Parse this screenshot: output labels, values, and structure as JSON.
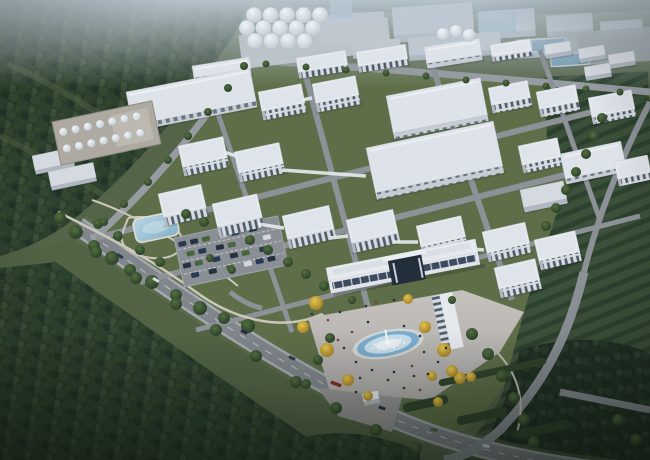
{
  "meta": {
    "description": "Aerial dusk rendering of an industrial park: grid of white factory buildings and warehouses, silo cluster, tank farm, park with pond and parking lot, central admin building with fountain plaza, surrounded by forest and field rows",
    "canvas": {
      "width": 650,
      "height": 460
    }
  },
  "palette": {
    "haze": "#c4cfd9",
    "distant_block": "#aeb9c6",
    "distant_roof": "#cdd6df",
    "glass": "#8fb0c6",
    "forest_base": "#2a3c29",
    "forest_dark": "#223425",
    "clearing": "#5c6b4a",
    "lawn": "#5f7047",
    "meadow": "#546444",
    "meadow_light": "#64744d",
    "road": "#85898e",
    "road_light": "#a9aeb2",
    "road_dash": "#d8dcdf",
    "path": "#d2ccbe",
    "plaza_a": "#cbc7c2",
    "plaza_b": "#b2aeab",
    "apron": "#9b9896",
    "roof_white": "#eef1f5",
    "roof_shade": "#e0e5eb",
    "roof_edge": "#c7ccd4",
    "warehouse_roof": "#e5e9ef",
    "shed_roof": "#dce0e6",
    "end_wall": "#b6bcc6",
    "win_base": "#dde1e7",
    "win_glass": "#4e5c6a",
    "wh_face": "#ccd2d9",
    "wh_glass": "#5a6876",
    "band_glass": "#3d4c5e",
    "portal": "#222e3a",
    "canopy": "#f2f4f7",
    "silo_pad": "#c6cdd4",
    "tank_yard": "#b3aea4",
    "tank_edge": "#938e84",
    "pool_rim": "#dadcd9",
    "pool_deep": "#7fb2d4",
    "pool_light": "#cfe6f2",
    "pond_edge": "#e9e5da",
    "hedge": "#2f4429",
    "people": "#2b2f36",
    "people_alt": "#7d3b30",
    "basin": "#6f98b2",
    "pad_grey": "#98a1a3",
    "car_colors": [
      "#49683c",
      "#2b3a54",
      "#24303e",
      "#d8dde2",
      "#8a2b22"
    ]
  },
  "scene": {
    "silos": {
      "x": 254,
      "y": 15,
      "dx": 16.5,
      "dy": 13,
      "r": 8,
      "rows": [
        5,
        5,
        4
      ],
      "row_offset": [
        0,
        -7,
        1
      ]
    },
    "domes": [
      [
        443,
        34,
        6.5
      ],
      [
        456,
        31,
        6.5
      ],
      [
        469,
        35,
        6.5
      ]
    ],
    "tanks": {
      "x": 9,
      "y": 12,
      "dx": 12.5,
      "dy": 17,
      "r": 4.3,
      "rows": 2,
      "cols": 7
    },
    "skybridges": [
      [
        224,
        152,
        236,
        156
      ],
      [
        302,
        100,
        312,
        98
      ],
      [
        282,
        170,
        366,
        176
      ],
      [
        258,
        224,
        284,
        228
      ],
      [
        330,
        238,
        348,
        236
      ],
      [
        394,
        242,
        418,
        242
      ],
      [
        460,
        248,
        484,
        250
      ]
    ],
    "hedges": [
      [
        402,
        404,
        46,
        9
      ],
      [
        456,
        417,
        52,
        9
      ],
      [
        514,
        431,
        56,
        9
      ],
      [
        438,
        380,
        110,
        7
      ]
    ],
    "trees_green": [
      [
        60,
        218,
        6
      ],
      [
        76,
        232,
        7
      ],
      [
        94,
        246,
        6
      ],
      [
        112,
        258,
        7
      ],
      [
        130,
        270,
        6
      ],
      [
        152,
        282,
        7
      ],
      [
        176,
        295,
        6
      ],
      [
        200,
        308,
        7
      ],
      [
        224,
        318,
        6
      ],
      [
        248,
        326,
        7
      ],
      [
        118,
        236,
        5
      ],
      [
        98,
        224,
        5
      ],
      [
        140,
        250,
        5
      ],
      [
        160,
        262,
        5
      ],
      [
        186,
        214,
        5
      ],
      [
        204,
        222,
        5
      ],
      [
        250,
        240,
        5
      ],
      [
        268,
        250,
        5
      ],
      [
        288,
        262,
        5
      ],
      [
        306,
        274,
        5
      ],
      [
        324,
        286,
        5
      ],
      [
        210,
        258,
        4
      ],
      [
        232,
        270,
        4
      ],
      [
        96,
        252,
        6
      ],
      [
        136,
        278,
        6
      ],
      [
        176,
        304,
        6
      ],
      [
        216,
        330,
        6
      ],
      [
        256,
        356,
        6
      ],
      [
        296,
        382,
        6
      ],
      [
        336,
        408,
        6
      ],
      [
        376,
        430,
        6
      ],
      [
        416,
        448,
        6
      ],
      [
        472,
        334,
        6
      ],
      [
        488,
        354,
        6
      ],
      [
        502,
        376,
        6
      ],
      [
        514,
        398,
        6
      ],
      [
        524,
        420,
        6
      ],
      [
        534,
        442,
        6
      ],
      [
        546,
        226,
        5
      ],
      [
        556,
        208,
        5
      ],
      [
        566,
        190,
        5
      ],
      [
        576,
        172,
        5
      ],
      [
        586,
        154,
        5
      ],
      [
        594,
        136,
        5
      ],
      [
        602,
        118,
        5
      ],
      [
        244,
        66,
        4
      ],
      [
        228,
        88,
        4
      ],
      [
        208,
        112,
        4
      ],
      [
        188,
        136,
        4
      ],
      [
        168,
        160,
        4
      ],
      [
        148,
        182,
        4
      ],
      [
        124,
        204,
        4
      ],
      [
        104,
        222,
        4
      ],
      [
        266,
        64,
        3.5
      ],
      [
        306,
        67,
        3.5
      ],
      [
        346,
        70,
        3.5
      ],
      [
        386,
        73,
        3.5
      ],
      [
        426,
        76,
        3.5
      ],
      [
        466,
        80,
        3.5
      ],
      [
        506,
        83,
        3.5
      ],
      [
        546,
        86,
        3.5
      ],
      [
        586,
        89,
        3.5
      ],
      [
        620,
        92,
        3.5
      ],
      [
        330,
        338,
        5
      ],
      [
        318,
        360,
        5
      ],
      [
        306,
        384,
        5
      ],
      [
        352,
        300,
        4
      ],
      [
        452,
        300,
        4
      ],
      [
        618,
        420,
        6
      ],
      [
        636,
        440,
        6
      ]
    ],
    "trees_yellow": [
      [
        316,
        303,
        7
      ],
      [
        303,
        327,
        6
      ],
      [
        327,
        350,
        7
      ],
      [
        348,
        380,
        6
      ],
      [
        368,
        396,
        5
      ],
      [
        425,
        327,
        6
      ],
      [
        444,
        350,
        7
      ],
      [
        460,
        378,
        6
      ],
      [
        438,
        402,
        5
      ],
      [
        408,
        299,
        5
      ],
      [
        432,
        376,
        5
      ],
      [
        452,
        371,
        6
      ],
      [
        471,
        377,
        5
      ]
    ],
    "parking_cars": [
      [
        3,
        5,
        1
      ],
      [
        15,
        5,
        2
      ],
      [
        27,
        5,
        0
      ],
      [
        45,
        5,
        3
      ],
      [
        57,
        5,
        1
      ],
      [
        75,
        5,
        2
      ],
      [
        9,
        16,
        0
      ],
      [
        21,
        16,
        1
      ],
      [
        39,
        16,
        2
      ],
      [
        51,
        16,
        0
      ],
      [
        69,
        16,
        1
      ],
      [
        87,
        16,
        3
      ],
      [
        3,
        27,
        2
      ],
      [
        15,
        27,
        0
      ],
      [
        33,
        27,
        1
      ],
      [
        51,
        27,
        2
      ],
      [
        63,
        27,
        0
      ],
      [
        81,
        27,
        1
      ],
      [
        9,
        38,
        1
      ],
      [
        27,
        38,
        2
      ],
      [
        45,
        38,
        0
      ],
      [
        63,
        38,
        3
      ],
      [
        75,
        38,
        1
      ],
      [
        87,
        38,
        2
      ]
    ],
    "road_cars": [
      [
        120,
        256,
        1,
        33
      ],
      [
        156,
        280,
        3,
        31
      ],
      [
        198,
        306,
        0,
        29
      ],
      [
        244,
        332,
        2,
        27
      ],
      [
        292,
        358,
        1,
        24
      ],
      [
        336,
        384,
        4,
        20
      ],
      [
        382,
        408,
        2,
        17
      ],
      [
        434,
        430,
        0,
        13
      ],
      [
        486,
        446,
        3,
        10
      ],
      [
        560,
        462,
        1,
        6
      ]
    ],
    "people": [
      [
        352,
        332
      ],
      [
        344,
        348
      ],
      [
        356,
        362
      ],
      [
        372,
        370
      ],
      [
        394,
        372
      ],
      [
        412,
        366
      ],
      [
        424,
        352
      ],
      [
        420,
        336
      ],
      [
        404,
        326
      ],
      [
        368,
        322
      ],
      [
        338,
        340
      ],
      [
        360,
        378
      ],
      [
        388,
        380
      ],
      [
        414,
        376
      ],
      [
        340,
        312
      ],
      [
        328,
        320
      ],
      [
        312,
        314
      ],
      [
        446,
        348
      ],
      [
        438,
        362
      ],
      [
        428,
        374
      ],
      [
        376,
        302
      ],
      [
        394,
        300
      ],
      [
        366,
        306
      ],
      [
        404,
        388
      ],
      [
        356,
        392
      ],
      [
        420,
        390
      ]
    ]
  },
  "buildings": [
    {
      "k": "d",
      "x": 318,
      "y": 16,
      "w": 66,
      "h": 24,
      "f": 6,
      "a": -4
    },
    {
      "k": "d",
      "x": 392,
      "y": 8,
      "w": 80,
      "h": 28,
      "f": 7,
      "a": -4
    },
    {
      "k": "d",
      "x": 478,
      "y": 12,
      "w": 56,
      "h": 22,
      "f": 6,
      "a": -4
    },
    {
      "k": "d",
      "x": 408,
      "y": 38,
      "w": 92,
      "h": 18,
      "f": 5,
      "a": -4
    },
    {
      "k": "d",
      "x": 546,
      "y": 16,
      "w": 46,
      "h": 16,
      "f": 5,
      "a": -4
    },
    {
      "k": "d",
      "x": 600,
      "y": 22,
      "w": 42,
      "h": 14,
      "f": 4,
      "a": -4
    },
    {
      "k": "d",
      "x": 516,
      "y": 40,
      "w": 62,
      "h": 14,
      "f": 5,
      "a": -4
    },
    {
      "k": "d",
      "x": 352,
      "y": 42,
      "w": 48,
      "h": 13,
      "f": 4,
      "a": -4
    },
    {
      "k": "w",
      "x": 192,
      "y": 66,
      "w": 58,
      "h": 12,
      "f": 5,
      "a": -9
    },
    {
      "k": "t",
      "x": 296,
      "y": 58,
      "w": 50,
      "h": 15,
      "f": 6,
      "a": -9
    },
    {
      "k": "t",
      "x": 356,
      "y": 52,
      "w": 50,
      "h": 15,
      "f": 6,
      "a": -9
    },
    {
      "k": "w",
      "x": 424,
      "y": 47,
      "w": 56,
      "h": 17,
      "f": 5,
      "a": -9
    },
    {
      "k": "t",
      "x": 490,
      "y": 45,
      "w": 40,
      "h": 12,
      "f": 5,
      "a": -9
    },
    {
      "k": "s",
      "x": 544,
      "y": 45,
      "w": 26,
      "h": 10,
      "f": 4,
      "a": -9
    },
    {
      "k": "s",
      "x": 578,
      "y": 49,
      "w": 26,
      "h": 10,
      "f": 4,
      "a": -9
    },
    {
      "k": "s",
      "x": 608,
      "y": 55,
      "w": 26,
      "h": 10,
      "f": 4,
      "a": -9
    },
    {
      "k": "s",
      "x": 584,
      "y": 67,
      "w": 26,
      "h": 10,
      "f": 4,
      "a": -9
    },
    {
      "k": "w",
      "x": 126,
      "y": 92,
      "w": 126,
      "h": 34,
      "f": 6,
      "a": -11
    },
    {
      "k": "t",
      "x": 258,
      "y": 92,
      "w": 44,
      "h": 20,
      "f": 9,
      "a": -11
    },
    {
      "k": "t",
      "x": 312,
      "y": 84,
      "w": 44,
      "h": 20,
      "f": 9,
      "a": -11
    },
    {
      "k": "w",
      "x": 386,
      "y": 96,
      "w": 96,
      "h": 38,
      "f": 6,
      "a": -11
    },
    {
      "k": "t",
      "x": 488,
      "y": 88,
      "w": 40,
      "h": 18,
      "f": 8,
      "a": -11
    },
    {
      "k": "t",
      "x": 536,
      "y": 92,
      "w": 40,
      "h": 18,
      "f": 8,
      "a": -11
    },
    {
      "k": "t",
      "x": 588,
      "y": 98,
      "w": 44,
      "h": 20,
      "f": 7,
      "a": -11
    },
    {
      "k": "s",
      "x": 32,
      "y": 156,
      "w": 40,
      "h": 15,
      "f": 4,
      "a": -12
    },
    {
      "k": "s",
      "x": 48,
      "y": 172,
      "w": 46,
      "h": 15,
      "f": 4,
      "a": -12
    },
    {
      "k": "t",
      "x": 178,
      "y": 146,
      "w": 46,
      "h": 22,
      "f": 9,
      "a": -12
    },
    {
      "k": "t",
      "x": 234,
      "y": 152,
      "w": 46,
      "h": 22,
      "f": 9,
      "a": -12
    },
    {
      "k": "w",
      "x": 366,
      "y": 148,
      "w": 130,
      "h": 46,
      "f": 7,
      "a": -12
    },
    {
      "k": "t",
      "x": 518,
      "y": 146,
      "w": 40,
      "h": 20,
      "f": 8,
      "a": -12
    },
    {
      "k": "w",
      "x": 560,
      "y": 154,
      "w": 62,
      "h": 26,
      "f": 5,
      "a": -12
    },
    {
      "k": "s",
      "x": 520,
      "y": 190,
      "w": 44,
      "h": 18,
      "f": 5,
      "a": -12
    },
    {
      "k": "t",
      "x": 614,
      "y": 162,
      "w": 34,
      "h": 18,
      "f": 7,
      "a": -12
    },
    {
      "k": "t",
      "x": 158,
      "y": 194,
      "w": 44,
      "h": 24,
      "f": 9,
      "a": -13
    },
    {
      "k": "t",
      "x": 212,
      "y": 204,
      "w": 46,
      "h": 24,
      "f": 10,
      "a": -13
    },
    {
      "k": "t",
      "x": 282,
      "y": 216,
      "w": 48,
      "h": 24,
      "f": 10,
      "a": -13
    },
    {
      "k": "t",
      "x": 346,
      "y": 220,
      "w": 48,
      "h": 24,
      "f": 10,
      "a": -13
    },
    {
      "k": "t",
      "x": 416,
      "y": 226,
      "w": 46,
      "h": 22,
      "f": 10,
      "a": -13
    },
    {
      "k": "t",
      "x": 482,
      "y": 232,
      "w": 44,
      "h": 22,
      "f": 9,
      "a": -13
    },
    {
      "k": "t",
      "x": 534,
      "y": 240,
      "w": 42,
      "h": 22,
      "f": 9,
      "a": -13
    },
    {
      "k": "t",
      "x": 494,
      "y": 268,
      "w": 42,
      "h": 22,
      "f": 9,
      "a": -13
    }
  ]
}
